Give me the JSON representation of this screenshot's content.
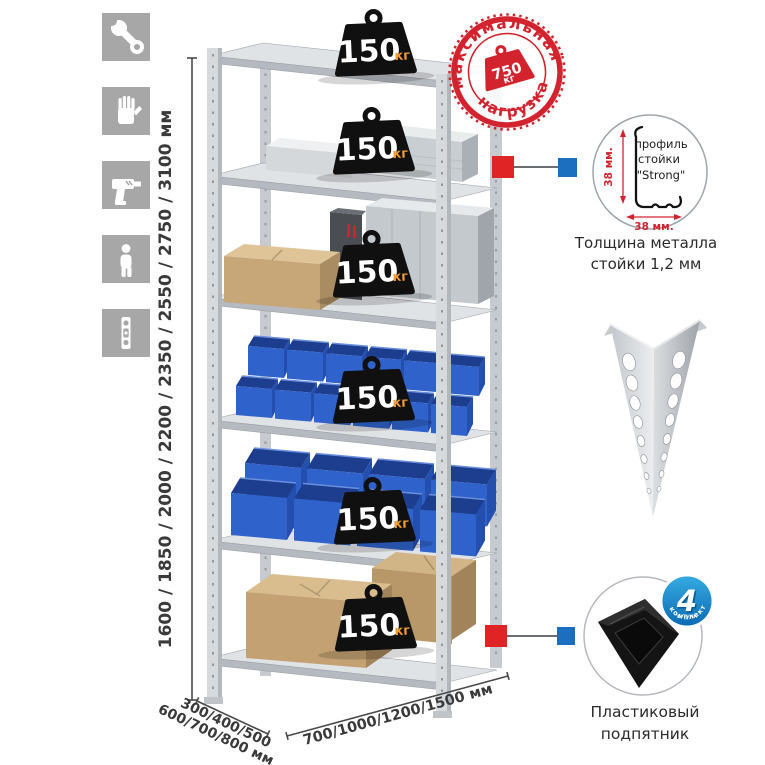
{
  "sidebar": {
    "icons": [
      {
        "name": "wrench"
      },
      {
        "name": "gloves"
      },
      {
        "name": "drill"
      },
      {
        "name": "person"
      },
      {
        "name": "level"
      }
    ]
  },
  "dimensions": {
    "height": "1600 / 1850 / 2000 / 2200 / 2350 / 2550 / 2750 / 3100 мм",
    "depth_line1": "300/400/500",
    "depth_line2": "600/700/800 мм",
    "width": "700/1000/1200/1500 мм"
  },
  "shelf_load": {
    "value": "150",
    "unit": "кг",
    "shelf_count": 6
  },
  "max_load_stamp": {
    "arc_top": "максимальная",
    "arc_bottom": "нагрузка",
    "value": "750",
    "unit": "кг"
  },
  "profile_detail": {
    "label_line1": "профиль",
    "label_line2": "стойки",
    "label_line3": "\"Strong\"",
    "dim_vertical": "38 мм.",
    "dim_horizontal": "38 мм.",
    "caption_line1": "Толщина металла",
    "caption_line2": "стойки 1,2 мм"
  },
  "foot_detail": {
    "badge_number": "4",
    "badge_word": "штуки",
    "badge_arc": "в комплекте",
    "caption_line1": "Пластиковый",
    "caption_line2": "подпятник"
  },
  "colors": {
    "stamp_red": "#d2232e",
    "connector_red": "#e02325",
    "connector_blue": "#1c6fbf",
    "bin_blue": "#2f63cb",
    "weight_unit_orange": "#f29b2e",
    "badge_blue": "#1182c4",
    "icon_gray": "#a7a7a7"
  }
}
